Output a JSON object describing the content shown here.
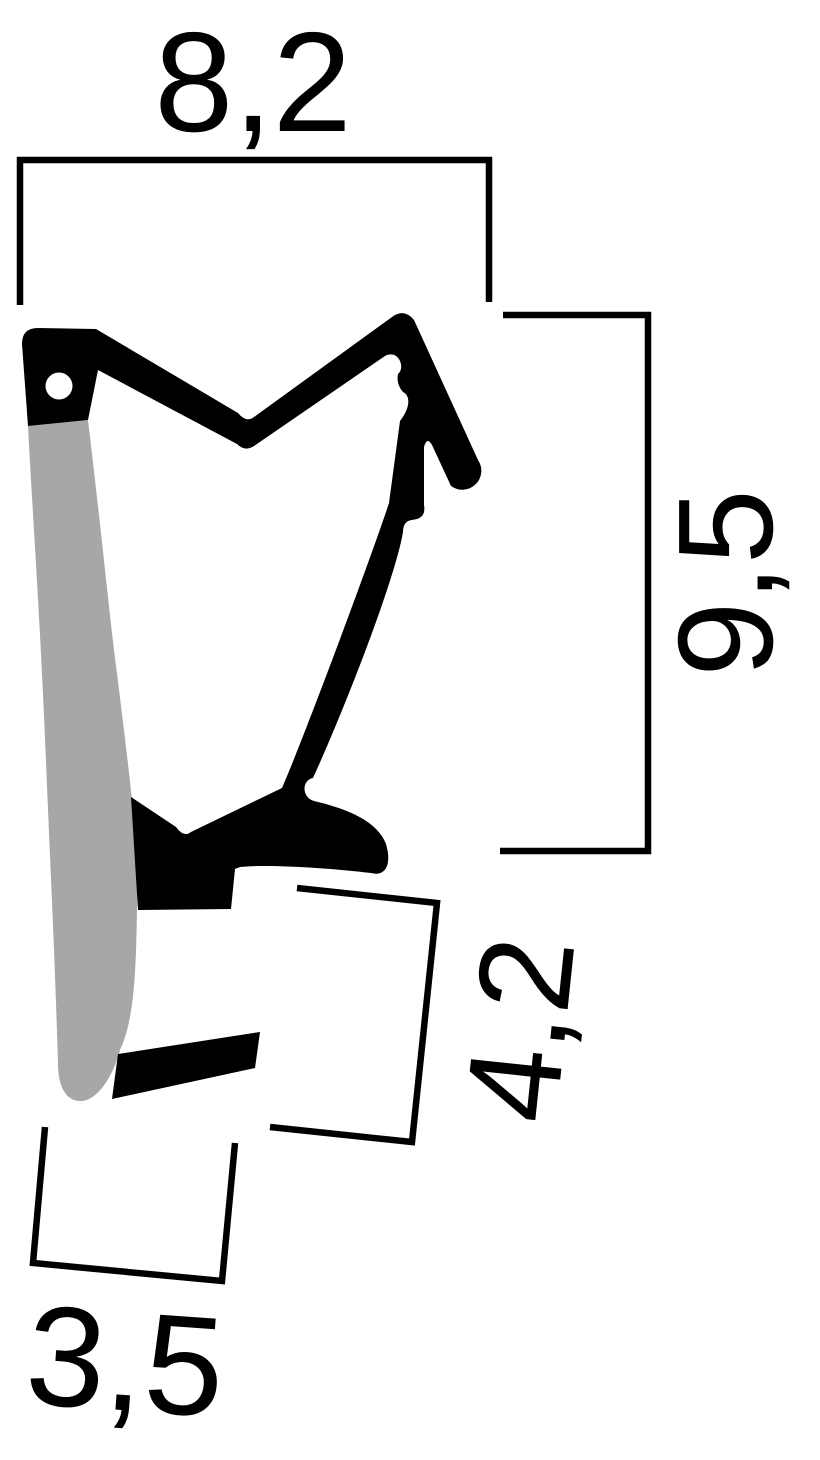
{
  "drawing": {
    "type": "seal-profile-cross-section",
    "dimensions": {
      "top_width": {
        "label": "8,2",
        "value": 8.2
      },
      "right_height": {
        "label": "9,5",
        "value": 9.5
      },
      "mid_height": {
        "label": "4,2",
        "value": 4.2
      },
      "bottom_width": {
        "label": "3,5",
        "value": 3.5
      }
    },
    "colors": {
      "ink": "#000000",
      "soft_part": "#a7a7a7",
      "background": "#ffffff"
    }
  }
}
